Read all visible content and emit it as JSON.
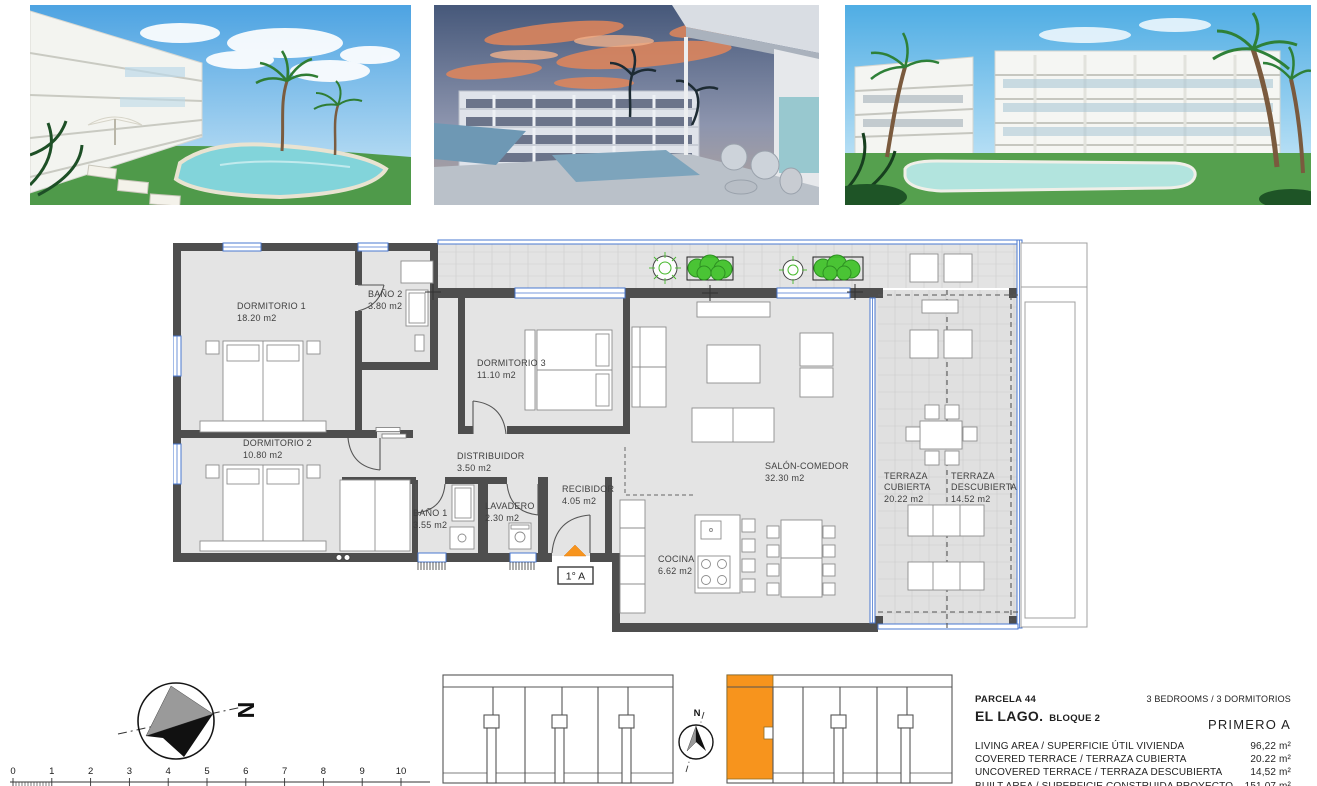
{
  "floorplan": {
    "unit_label": "1° A",
    "rooms": [
      {
        "name": "DORMITORIO 1",
        "area": "18.20 m2"
      },
      {
        "name": "BAÑO 2",
        "area": "3.80 m2"
      },
      {
        "name": "DORMITORIO 3",
        "area": "11.10 m2"
      },
      {
        "name": "DORMITORIO 2",
        "area": "10.80 m2"
      },
      {
        "name": "DISTRIBUIDOR",
        "area": "3.50 m2"
      },
      {
        "name": "BAÑO 1",
        "area": "3.55 m2"
      },
      {
        "name": "LAVADERO",
        "area": "2.30 m2"
      },
      {
        "name": "RECIBIDOR",
        "area": "4.05 m2"
      },
      {
        "name": "COCINA",
        "area": "6.62 m2"
      },
      {
        "name": "SALÓN-COMEDOR",
        "area": "32.30 m2"
      },
      {
        "name": "TERRAZA CUBIERTA",
        "name_line1": "TERRAZA",
        "name_line2": "CUBIERTA",
        "area": "20.22 m2"
      },
      {
        "name": "TERRAZA DESCUBIERTA",
        "name_line1": "TERRAZA",
        "name_line2": "DESCUBIERTA",
        "area": "14.52 m2"
      }
    ]
  },
  "compass": {
    "north_label": "N"
  },
  "site_plan": {
    "north_label": "N"
  },
  "scalebar": {
    "ticks": [
      "0",
      "1",
      "2",
      "3",
      "4",
      "5",
      "6",
      "7",
      "8",
      "9",
      "10"
    ]
  },
  "info": {
    "parcela": "PARCELA  44",
    "project": "EL LAGO.",
    "bloque": "BLOQUE 2",
    "bedrooms": "3 BEDROOMS / 3 DORMITORIOS",
    "floor_unit": "PRIMERO  A",
    "rows": [
      {
        "label": "LIVING AREA / SUPERFICIE ÚTIL VIVIENDA",
        "value": "96,22 m²"
      },
      {
        "label": "COVERED TERRACE / TERRAZA CUBIERTA",
        "value": "20.22 m²"
      },
      {
        "label": "UNCOVERED TERRACE / TERRAZA DESCUBIERTA",
        "value": "14,52 m²"
      },
      {
        "label": "BUILT AREA / SUPERFICIE CONSTRUIDA PROYECTO",
        "value": "151.07 m²"
      }
    ]
  },
  "colors": {
    "accent_orange": "#F7941D",
    "wall_gray": "#4E4E4E",
    "window_blue": "#4A78D0",
    "plant_green": "#3EC227",
    "floor_gray": "#E4E4E4"
  }
}
